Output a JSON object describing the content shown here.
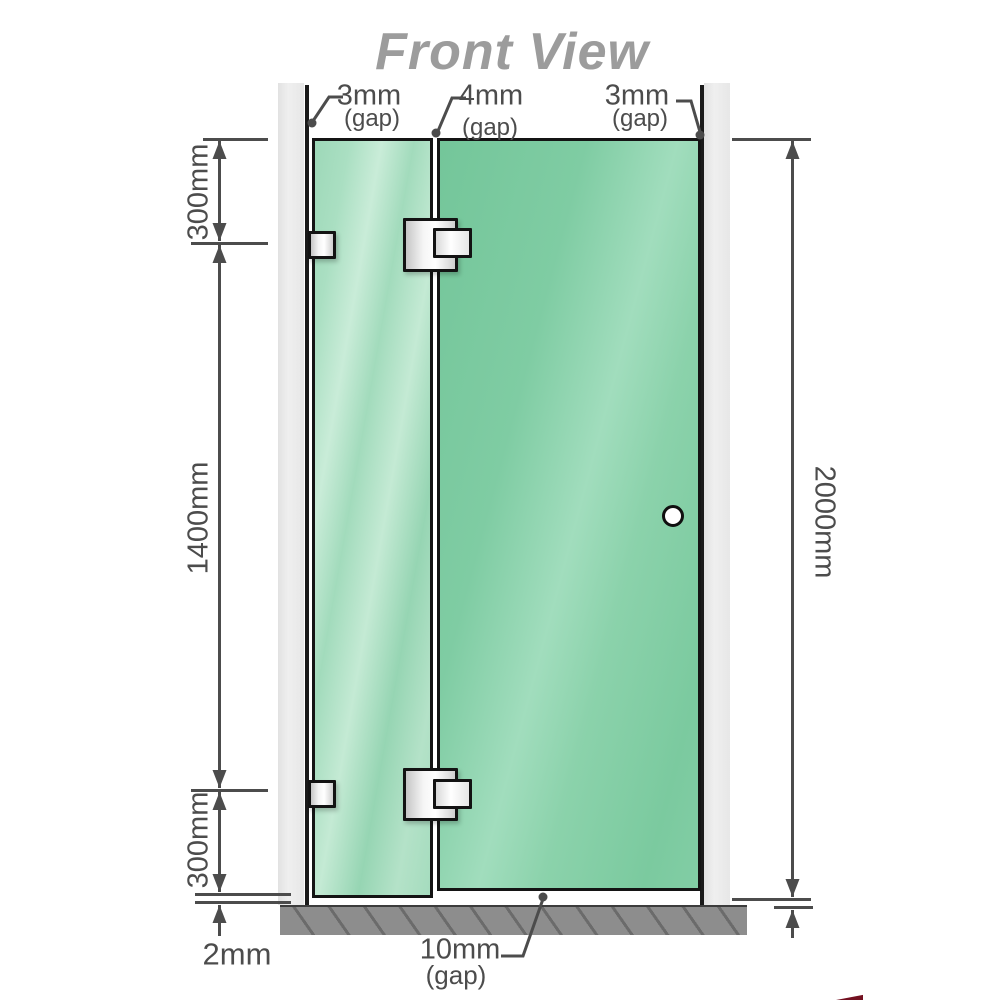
{
  "title": "Front View",
  "top_gaps": {
    "left": {
      "value": "3mm",
      "label": "(gap)"
    },
    "middle": {
      "value": "4mm",
      "label": "(gap)"
    },
    "right": {
      "value": "3mm",
      "label": "(gap)"
    }
  },
  "left_dims": {
    "top": "300mm",
    "middle": "1400mm",
    "bottom": "300mm",
    "floor_gap": "2mm"
  },
  "right_dims": {
    "total_height": "2000mm"
  },
  "bottom_gap": {
    "value": "10mm",
    "label": "(gap)"
  },
  "colors": {
    "glass_fixed": "#a3dcbd",
    "glass_door": "#82cda5",
    "wall": "#e9e9e9",
    "floor": "#8d8d8d",
    "outline": "#141414",
    "dimension": "#4c4c4c",
    "title": "#9c9c9c",
    "accent_red": "#731020"
  }
}
